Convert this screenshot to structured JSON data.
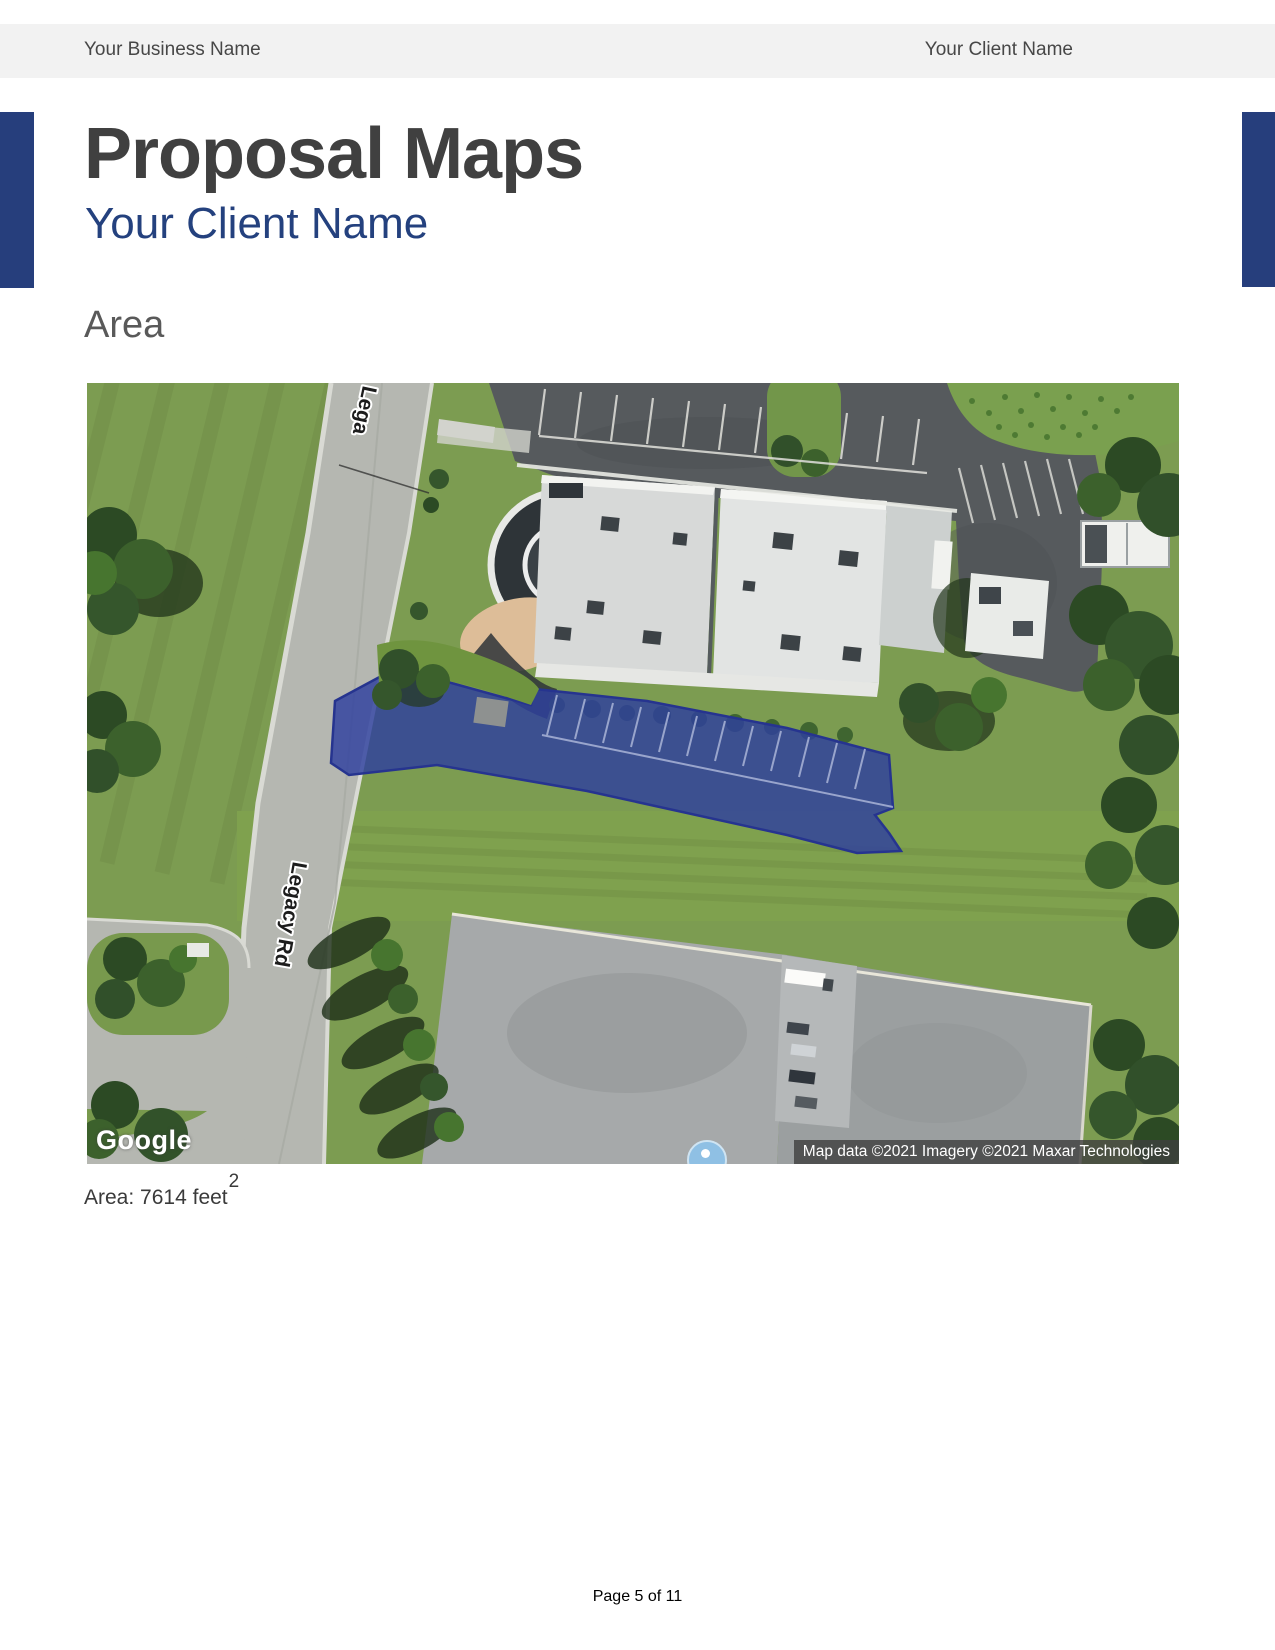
{
  "header": {
    "business_name": "Your Business Name",
    "client_name": "Your Client Name"
  },
  "title": {
    "heading": "Proposal Maps",
    "subtitle": "Your Client Name"
  },
  "section": {
    "heading": "Area"
  },
  "map": {
    "road_label_top": "Lega",
    "road_label": "Legacy Rd",
    "google_logo": "Google",
    "attribution": "Map data ©2021 Imagery ©2021 Maxar Technologies",
    "highlight_color": "#2e3f9f"
  },
  "area_stat": {
    "label_prefix": "Area:",
    "value": "7614",
    "unit": "feet",
    "exponent": "2"
  },
  "footer": {
    "page_text": "Page 5 of 11"
  },
  "colors": {
    "accent_navy": "#263e7c",
    "subtitle_blue": "#24417e",
    "header_gray": "#f2f2f2",
    "title_gray": "#404040"
  }
}
